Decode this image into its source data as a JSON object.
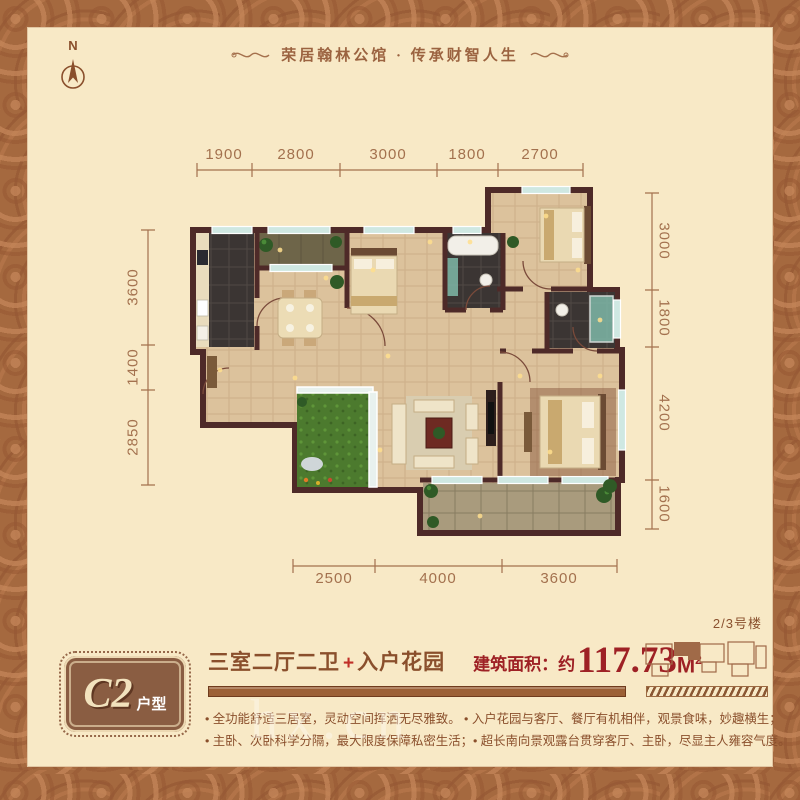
{
  "header": {
    "slogan": "荣居翰林公馆 · 传承财智人生"
  },
  "compass": {
    "north_label": "N"
  },
  "plan": {
    "dims_top": [
      "1900",
      "2800",
      "3000",
      "1800",
      "2700"
    ],
    "dims_left": [
      "3600",
      "1400",
      "2850"
    ],
    "dims_right": [
      "3000",
      "1800",
      "4200",
      "1600"
    ],
    "dims_bottom": [
      "2500",
      "4000",
      "3600"
    ]
  },
  "info": {
    "badge": {
      "model": "C2",
      "type_label": "户型"
    },
    "title": {
      "rooms": "三室二厅二卫",
      "plus": "+",
      "garden": "入户花园",
      "area_label": "建筑面积：约",
      "area_value": "117.73",
      "area_unit": "M",
      "area_exp": "2"
    },
    "building_key": {
      "label": "2/3号楼"
    },
    "bullet_lines": [
      "• 全功能舒适三居室，灵动空间挥洒无尽雅致。 • 入户花园与客厅、餐厅有机相伴，观景食味，妙趣横生；",
      "• 主卧、次卧科学分隔，最大限度保障私密生活；• 超长南向景观露台贯穿客厅、主卧，尽显主人雍容气度。"
    ]
  },
  "watermark": {
    "text": "hx.cn"
  }
}
